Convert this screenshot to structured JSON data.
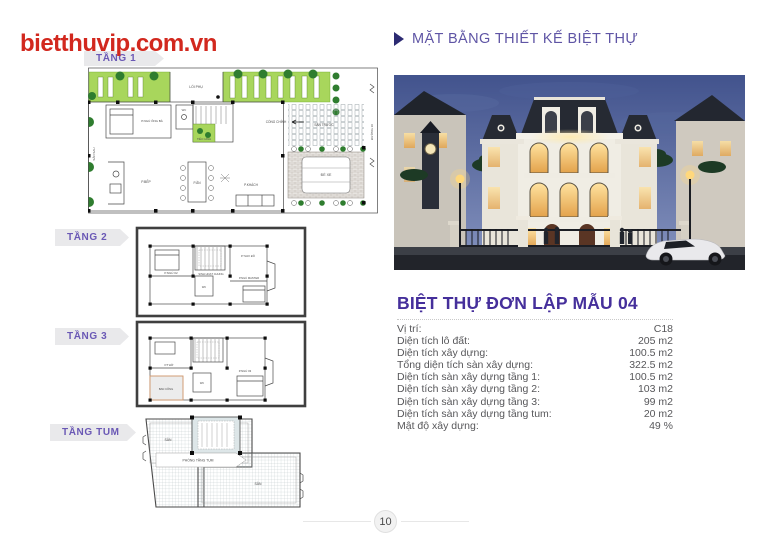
{
  "page": {
    "logo": "bietthuvip.com.vn",
    "page_number": "10"
  },
  "header": {
    "title": "MẶT BẰNG THIẾT KẾ BIỆT THỰ"
  },
  "colors": {
    "logo_red": "#d2281e",
    "header_purple": "#5f55a5",
    "title_purple": "#452f9b",
    "banner_text_purple": "#6a58b5",
    "plan_green": "#a8d65c"
  },
  "floor_plans": {
    "tang1": {
      "label": "TẦNG 1",
      "rooms": [
        "LỐI PHỤ",
        "CỔNG CHÍNH",
        "SÂN TRƯỚC",
        "ĐỂ XE",
        "SÂN SAU",
        "P.NGỦ ÔNG BÀ",
        "WC",
        "TIỂU CẢNH",
        "P.BẾP",
        "P.ĂN",
        "P.KHÁCH",
        "ĐƯỜNG 10"
      ]
    },
    "tang2": {
      "label": "TẦNG 2",
      "rooms": [
        "P.NGỦ 02",
        "SINH HOẠT CHUNG",
        "P.THAY ĐỒ",
        "P.NGỦ MASTER",
        "WC"
      ]
    },
    "tang3": {
      "label": "TẦNG 3",
      "rooms": [
        "P.THỜ",
        "BAN CÔNG",
        "P.NGỦ 03",
        "WC"
      ]
    },
    "tangtum": {
      "label": "TẦNG TUM",
      "rooms": [
        "SÂN",
        "PHÒNG TẦNG TUM",
        "SÂN"
      ]
    }
  },
  "villa": {
    "title": "BIỆT THỰ ĐƠN LẬP MẪU 04",
    "specs": [
      {
        "label": "Vị trí:",
        "value": "C18"
      },
      {
        "label": "Diện tích lô đất:",
        "value": "205 m2"
      },
      {
        "label": "Diện tích xây dựng:",
        "value": "100.5 m2"
      },
      {
        "label": "Tổng diện tích sàn xây dựng:",
        "value": "322.5 m2"
      },
      {
        "label": "Diện tích sàn xây dựng tầng 1:",
        "value": "100.5 m2"
      },
      {
        "label": "Diện tích sàn xây dựng tầng 2:",
        "value": "103 m2"
      },
      {
        "label": "Diện tích sàn xây dựng tầng 3:",
        "value": "99 m2"
      },
      {
        "label": "Diện tích sàn xây dựng tầng tum:",
        "value": "20 m2"
      },
      {
        "label": "Mật độ xây dựng:",
        "value": "49 %"
      }
    ]
  }
}
